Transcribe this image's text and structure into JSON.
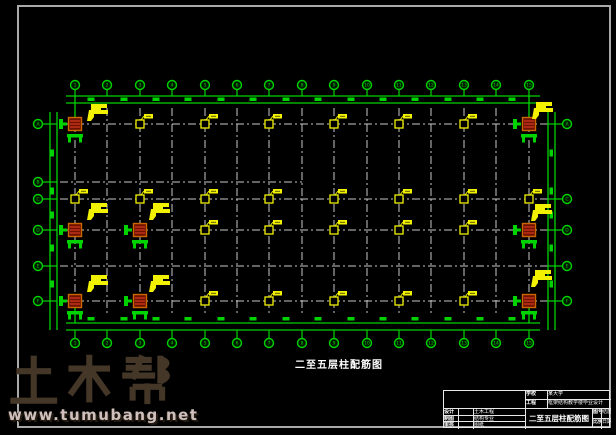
{
  "drawing": {
    "title": "二至五层柱配筋图",
    "colors": {
      "axis_green": "#00d400",
      "column_yellow": "#f2f200",
      "grid_gray": "#c9c9c9",
      "red_column_fill": "#6e1200",
      "red_column_hatch": "#d63b20",
      "red_column_stroke": "#cc6600",
      "frame_gray": "#a9a9a9",
      "text_white": "#ffffff"
    },
    "plan": {
      "cols_x": [
        75,
        107,
        140,
        172,
        205,
        237,
        269,
        302,
        334,
        367,
        399,
        431,
        464,
        496,
        529
      ],
      "rows_y": [
        124,
        182,
        199,
        230,
        266,
        301
      ],
      "partial_row": {
        "y": 182,
        "x_end": 302
      },
      "grid_top": 108,
      "grid_bottom": 315,
      "grid_left": 44,
      "grid_right": 562,
      "top_dim_lines_y": [
        96,
        103
      ],
      "bottom_dim_lines_y": [
        323,
        330
      ],
      "left_dim_lines_x": [
        50,
        57
      ],
      "right_dim_lines_x": [
        548,
        555
      ],
      "top_ticks_x": [
        91,
        124,
        156,
        188,
        221,
        253,
        286,
        318,
        351,
        383,
        415,
        448,
        480,
        512
      ],
      "left_ticks_y": [
        153,
        191,
        215,
        248,
        284
      ],
      "bubbles": {
        "top_cy": 85,
        "bottom_cy": 343,
        "left_cx": 38,
        "right_cx": 567,
        "top_labels": [
          "1",
          "2",
          "3",
          "4",
          "5",
          "6",
          "7",
          "8",
          "9",
          "10",
          "11",
          "12",
          "13",
          "14",
          "15"
        ],
        "bottom_labels": [
          "1",
          "2",
          "3",
          "4",
          "5",
          "6",
          "7",
          "8",
          "9",
          "10",
          "11",
          "12",
          "13",
          "14",
          "15"
        ],
        "left_labels": [
          "A",
          "B",
          "C",
          "D",
          "E",
          "F"
        ],
        "right_rows_y": [
          124,
          199,
          230,
          266,
          301
        ],
        "right_labels": [
          "A",
          "C",
          "D",
          "E",
          "F"
        ]
      },
      "yellow_columns": [
        {
          "x": 140,
          "y": 124
        },
        {
          "x": 205,
          "y": 124
        },
        {
          "x": 269,
          "y": 124
        },
        {
          "x": 334,
          "y": 124
        },
        {
          "x": 399,
          "y": 124
        },
        {
          "x": 464,
          "y": 124
        },
        {
          "x": 75,
          "y": 199
        },
        {
          "x": 140,
          "y": 199
        },
        {
          "x": 205,
          "y": 199
        },
        {
          "x": 269,
          "y": 199
        },
        {
          "x": 334,
          "y": 199
        },
        {
          "x": 399,
          "y": 199
        },
        {
          "x": 464,
          "y": 199
        },
        {
          "x": 529,
          "y": 199
        },
        {
          "x": 205,
          "y": 230
        },
        {
          "x": 269,
          "y": 230
        },
        {
          "x": 334,
          "y": 230
        },
        {
          "x": 399,
          "y": 230
        },
        {
          "x": 464,
          "y": 230
        },
        {
          "x": 205,
          "y": 301
        },
        {
          "x": 269,
          "y": 301
        },
        {
          "x": 334,
          "y": 301
        },
        {
          "x": 399,
          "y": 301
        },
        {
          "x": 464,
          "y": 301
        }
      ],
      "red_columns": [
        {
          "x": 75,
          "y": 124
        },
        {
          "x": 529,
          "y": 124
        },
        {
          "x": 75,
          "y": 230
        },
        {
          "x": 140,
          "y": 230
        },
        {
          "x": 529,
          "y": 230
        },
        {
          "x": 75,
          "y": 301
        },
        {
          "x": 140,
          "y": 301
        },
        {
          "x": 529,
          "y": 301
        }
      ],
      "flags": [
        {
          "x": 86,
          "y": 104
        },
        {
          "x": 531,
          "y": 102
        },
        {
          "x": 86,
          "y": 203
        },
        {
          "x": 148,
          "y": 203
        },
        {
          "x": 530,
          "y": 204
        },
        {
          "x": 86,
          "y": 275
        },
        {
          "x": 148,
          "y": 275
        },
        {
          "x": 530,
          "y": 270
        }
      ]
    }
  },
  "title_block": {
    "row1_label": "学校",
    "row1_value": "某大学",
    "row2_label": "工程",
    "row2_value": "框架结构教学楼毕业设计",
    "left_rows": [
      {
        "label": "设计",
        "mid": "",
        "value": "土木工程"
      },
      {
        "label": "制图",
        "mid": "",
        "value": "结构专业"
      },
      {
        "label": "审核",
        "mid": "",
        "value": "图纸"
      }
    ],
    "main_title": "二至五层柱配筋图",
    "right_cells": [
      {
        "a": "图号",
        "b": "结施"
      },
      {
        "a": "比例",
        "b": "日期"
      }
    ]
  },
  "watermark": {
    "brand": "土木帮",
    "url": "www.tumubang.net",
    "brand_color": "#453727",
    "url_color": "#cfc0bd"
  }
}
